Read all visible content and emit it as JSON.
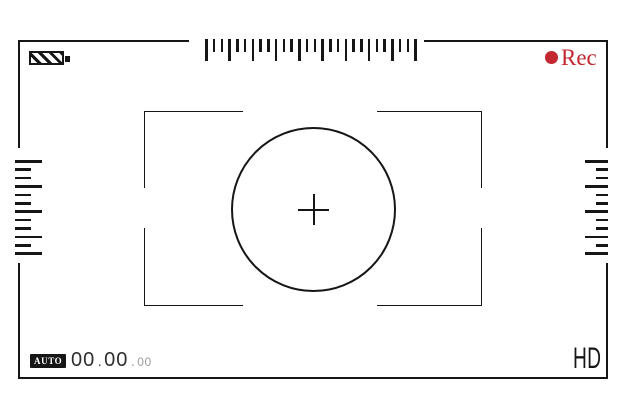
{
  "colors": {
    "line": "#161616",
    "rec_red": "#c32730",
    "timecode_dim": "#9b9b9b"
  },
  "header": {
    "battery_icon": "battery-icon",
    "rec": {
      "dot_icon": "record-dot-icon",
      "label": "Rec"
    }
  },
  "rulers": {
    "top": {
      "tick_count": 28,
      "major_every": 3
    },
    "left": {
      "pattern": [
        "major",
        "minor",
        "minor",
        "major",
        "minor",
        "minor",
        "major",
        "minor",
        "minor",
        "major",
        "minor",
        "major"
      ]
    },
    "right": {
      "pattern": [
        "major",
        "minor",
        "minor",
        "major",
        "minor",
        "minor",
        "major",
        "minor",
        "minor",
        "major",
        "minor",
        "major"
      ]
    }
  },
  "focus": {
    "crosshair_icon": "crosshair-icon"
  },
  "footer": {
    "auto_label": "AUTO",
    "timecode": {
      "hours": "00",
      "sep1": ".",
      "minutes": "00",
      "sep2": ".",
      "seconds": "00"
    },
    "hd_label": "HD"
  }
}
